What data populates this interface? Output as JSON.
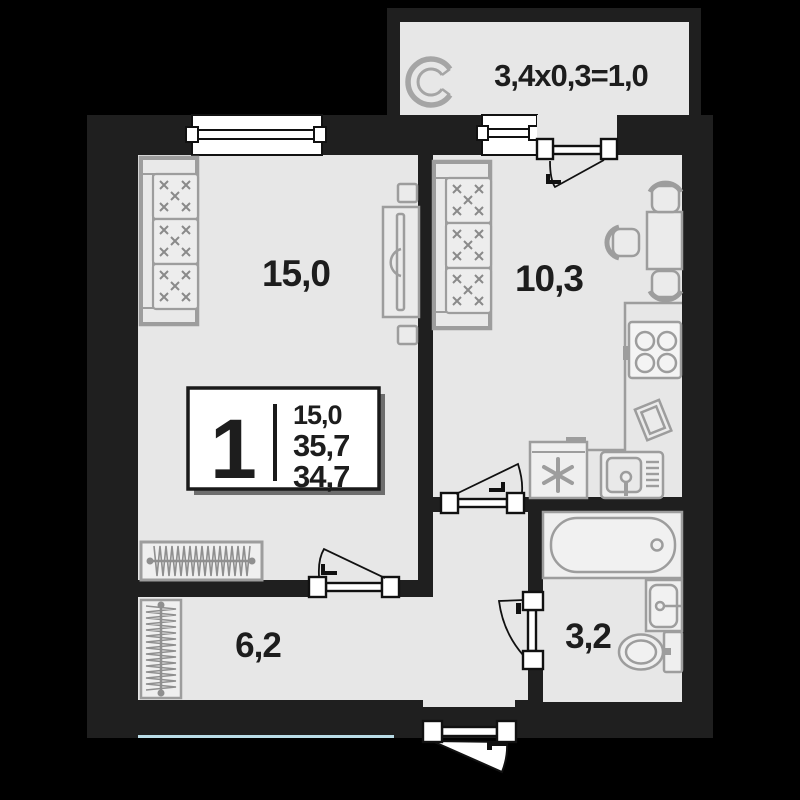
{
  "floor_plan": {
    "title": "1-room apartment floor plan",
    "rooms": {
      "living_room": {
        "name": "living room",
        "label": "15,0"
      },
      "kitchen": {
        "name": "kitchen",
        "label": "10,3"
      },
      "hallway": {
        "name": "hallway",
        "label": "6,2"
      },
      "bathroom": {
        "name": "bathroom",
        "label": "3,2"
      },
      "balcony": {
        "name": "balcony",
        "label": "3,4x0,3=1,0"
      }
    },
    "info_box": {
      "rooms_count": "1",
      "living_area": "15,0",
      "total_area": "35,7",
      "area_alt": "34,7"
    },
    "icons": {
      "fridge_symbol": "six-armed asterisk (freezer mark)",
      "balcony_unit": "air-conditioner / glazing arc symbol"
    },
    "colors": {
      "background": "#000000",
      "walls": "#1f1f1f",
      "floor": "#e7e7e7",
      "furniture_outline": "#9d9d9d",
      "door_window": "#ffffff",
      "facade_accent_line": "#b9dce7",
      "text": "#1d1d1d"
    }
  }
}
